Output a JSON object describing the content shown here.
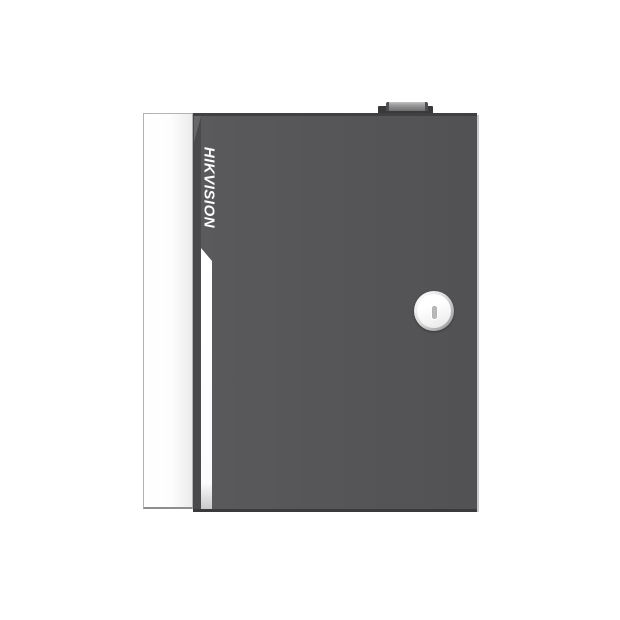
{
  "image": {
    "background_color": "#ffffff",
    "subject": "wall-mount metal enclosure with hinged door, key lock and top tab"
  },
  "product": {
    "brand": "HIKVISION",
    "brand_text_color": "#fdfdfd",
    "colors": {
      "door_face": "#565658",
      "door_edge_dark": "#3a3a3c",
      "door_right_highlight": "#c9c9c9",
      "side_panel": "#fdfdfd",
      "side_panel_border": "#b3b3b3",
      "stripe": "#fbfbfb",
      "hinge_bar": "#9a9a9a",
      "lock_ring": "#cfcfcf",
      "lock_face": "#f3f3f3",
      "lock_slot": "#b9b9b9"
    }
  }
}
